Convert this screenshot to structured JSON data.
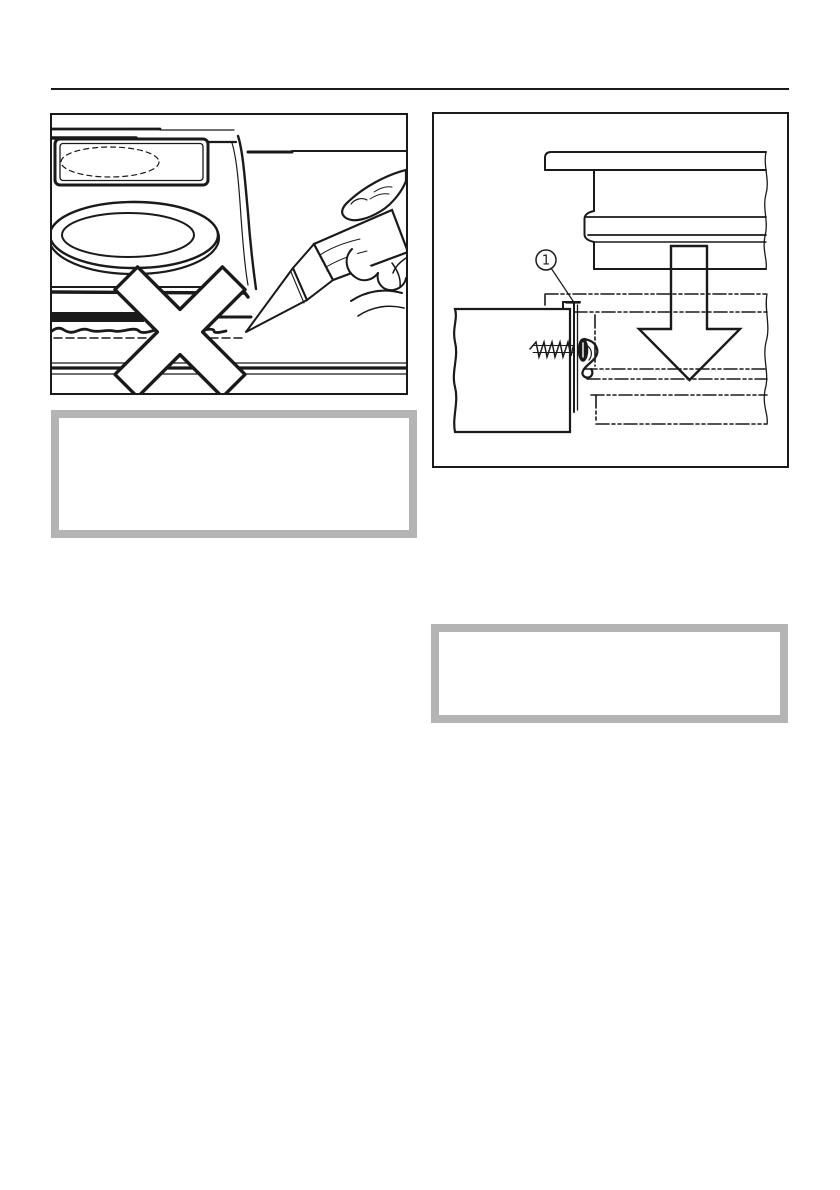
{
  "page": {
    "background": "#ffffff"
  },
  "colors": {
    "ink": "#1a1a1a",
    "note_frame": "#b4b4b4",
    "paper": "#ffffff"
  },
  "header": {
    "rule_present": true
  },
  "figures": {
    "sealant_prohibition": {
      "icons": [
        "cooktop-illustration",
        "burner-ellipses",
        "caulk-gun-hand",
        "sealant-bead",
        "prohibition-x-mark"
      ],
      "text": ""
    },
    "bracket_mounting": {
      "icons": [
        "cooktop-profile",
        "down-arrow",
        "worktop-phantom-outline",
        "cabinet-panel",
        "mounting-screw",
        "spring-clip",
        "fixing-bracket"
      ],
      "callout_label": "1"
    }
  },
  "note_boxes": {
    "left_text": "",
    "right_text": ""
  }
}
